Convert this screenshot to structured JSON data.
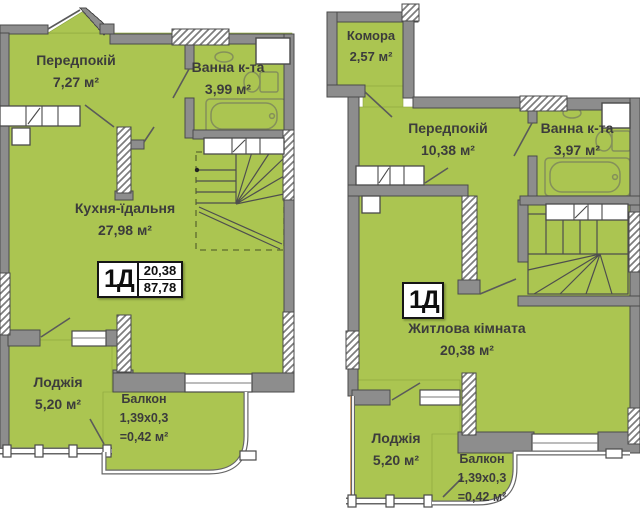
{
  "plans": [
    {
      "level": "lower",
      "badge": {
        "type": "1Д",
        "area_level": "20,38",
        "area_total": "87,78"
      },
      "rooms": {
        "hallway": {
          "name": "Передпокій",
          "area": "7,27 м²"
        },
        "bathroom": {
          "name": "Ванна к-та",
          "area": "3,99 м²"
        },
        "kitchen": {
          "name": "Кухня-їдальня",
          "area": "27,98 м²"
        },
        "loggia": {
          "name": "Лоджія",
          "area": "5,20 м²"
        },
        "balcony": {
          "name": "Балкон",
          "dimensions": "1,39х0,3",
          "area": "=0,42 м²"
        }
      }
    },
    {
      "level": "upper",
      "badge": {
        "type": "1Д"
      },
      "rooms": {
        "storage": {
          "name": "Комора",
          "area": "2,57 м²"
        },
        "hallway": {
          "name": "Передпокій",
          "area": "10,38 м²"
        },
        "bathroom": {
          "name": "Ванна к-та",
          "area": "3,97 м²"
        },
        "living": {
          "name": "Житлова кімната",
          "area": "20,38 м²"
        },
        "loggia": {
          "name": "Лоджія",
          "area": "5,20 м²"
        },
        "balcony": {
          "name": "Балкон",
          "dimensions": "1,39х0,3",
          "area": "=0,42 м²"
        }
      }
    }
  ],
  "colors": {
    "room_fill": "#abc551",
    "wall_fill": "#8d8d8d",
    "wall_stroke": "#4a4a4a",
    "background": "#ffffff",
    "label_text": "#3c3c3c"
  }
}
